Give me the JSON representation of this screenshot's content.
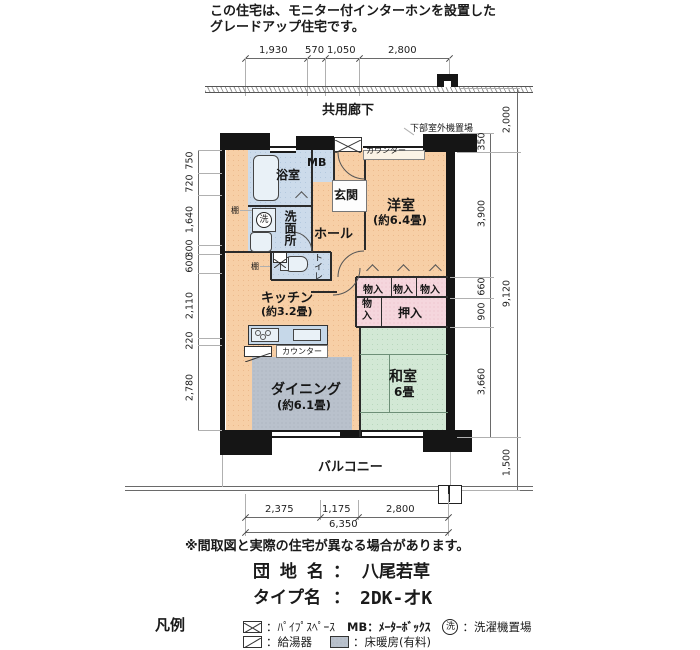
{
  "title_note": {
    "line1": "この住宅は、モニター付インターホンを設置した",
    "line2": "グレードアップ住宅です。"
  },
  "corridor_label": "共用廊下",
  "dims": {
    "top": [
      "1,930",
      "570",
      "1,050",
      "2,800"
    ],
    "left": [
      "750",
      "720",
      "1,640",
      "300",
      "600",
      "2,110",
      "220",
      "2,780"
    ],
    "right_inner": [
      "350",
      "3,900",
      "660",
      "900",
      "3,660"
    ],
    "right_total": "9,120",
    "corridor_depth": "2,000",
    "balcony_depth": "1,500",
    "bottom": [
      "2,375",
      "1,175",
      "2,800"
    ],
    "bottom_total": "6,350"
  },
  "plan": {
    "outdoor_unit": "下部室外機置場",
    "counter": "カウンター",
    "bath": "浴室",
    "mb": "MB",
    "entrance": "玄関",
    "washroom": "洗面所",
    "hall": "ホール",
    "toilet": "トイレ",
    "shelf": "棚",
    "western_name": "洋室",
    "western_size": "(約6.4畳)",
    "kitchen_name": "キッチン",
    "kitchen_size": "(約3.2畳)",
    "dining_name": "ダイニング",
    "dining_size": "(約6.1畳)",
    "washitsu_name": "和室",
    "washitsu_size": "6畳",
    "storage": "物入",
    "oshiire": "押入",
    "balcony": "バルコニー",
    "laundry_mark": "洗"
  },
  "footer": {
    "disclaimer": "※間取図と実際の住宅が異なる場合があります。",
    "estate_label": "団 地 名",
    "colon": "：",
    "estate_value": "八尾若草",
    "type_label": "タイプ名",
    "type_value": "2DK-オK"
  },
  "legend": {
    "title": "凡例",
    "pipe_label": "：ﾊﾟｲﾌﾟｽﾍﾟｰｽ",
    "mb_label": "MB：ﾒｰﾀｰﾎﾞｯｸｽ",
    "laundry_mark": "洗",
    "laundry_label": "：洗濯機置場",
    "heater_label": "：給湯器",
    "floorheat_label": "：床暖房(有料)"
  },
  "colors": {
    "floor": "#f7cfa6",
    "wet_area": "#ccdbeb",
    "tatami": "#d2e8d5",
    "closet": "#f5d6dd",
    "floor_heating": "#b9c1cc",
    "wall": "#151515"
  }
}
